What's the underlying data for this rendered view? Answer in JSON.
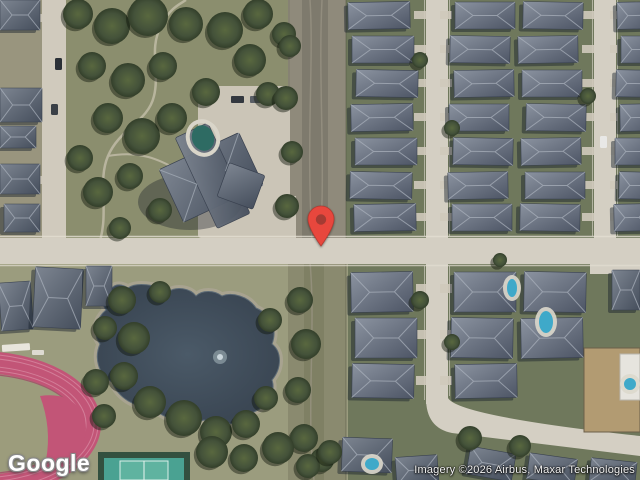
{
  "map": {
    "view": "satellite",
    "pin": {
      "name": "map-pin",
      "x": 321,
      "y": 246,
      "color": "#E8473D",
      "inner_color": "#A43B33"
    },
    "regions": [
      "residential-neighborhood",
      "park",
      "church-campus",
      "parking-lot",
      "drainage-strip",
      "pond",
      "running-track",
      "tennis-court",
      "main-road",
      "dirt-lot"
    ],
    "colors": {
      "road": "#d4cfc3",
      "park_grass": "#8b8e6e",
      "lot_green": "#6f785c",
      "field_grass": "#9b9c7e",
      "water": "#42505c",
      "track_pink": "#c25577",
      "tennis_teal": "#4aa292",
      "roof_gray": "#6c7584",
      "roof_shadow": "#39404f",
      "parking": "#cbc5b7",
      "scrub": "#8f8a7b",
      "tree_green": "#44523a",
      "pool_blue": "#3fa9c9"
    }
  },
  "footer": {
    "logo": "Google",
    "attribution": "Imagery ©2026 Airbus, Maxar Technologies"
  }
}
